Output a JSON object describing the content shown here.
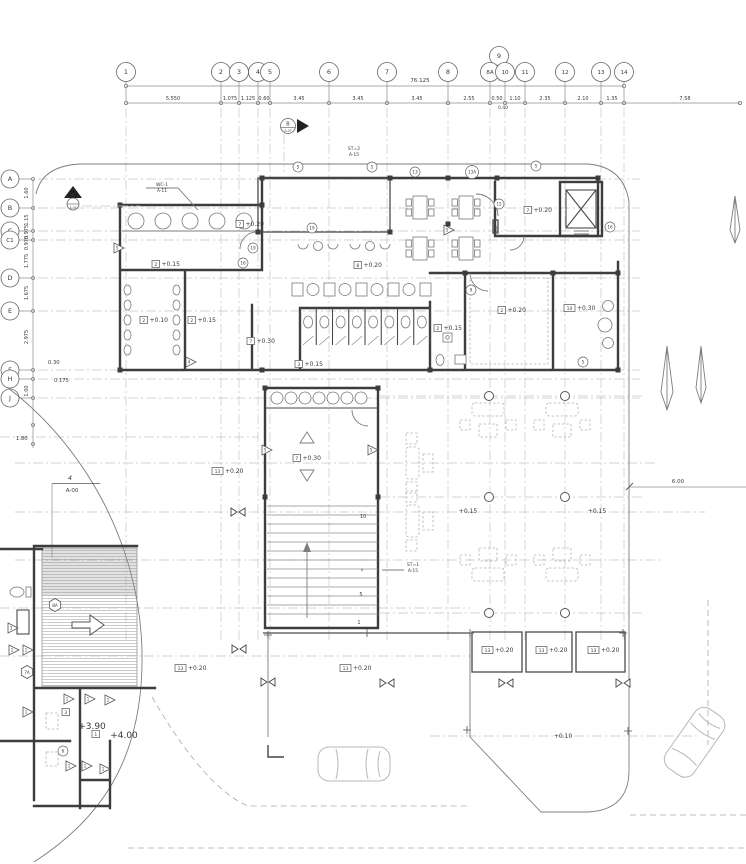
{
  "meta": {
    "bg": "#ffffff",
    "wall_color": "#3d3d3d",
    "grid_color": "#ccc2c2",
    "thin_color": "#8c8c8c",
    "text_color": "#3a3a3a"
  },
  "grid": {
    "cols": [
      {
        "l": "1",
        "x": 126
      },
      {
        "l": "2",
        "x": 221
      },
      {
        "l": "3",
        "x": 239
      },
      {
        "l": "4",
        "x": 258
      },
      {
        "l": "5",
        "x": 270
      },
      {
        "l": "6",
        "x": 329
      },
      {
        "l": "7",
        "x": 387
      },
      {
        "l": "8",
        "x": 448
      },
      {
        "l": "9",
        "x": 499,
        "y": 56,
        "nol": true
      },
      {
        "l": "8A",
        "x": 490
      },
      {
        "l": "10",
        "x": 505
      },
      {
        "l": "11",
        "x": 525
      },
      {
        "l": "12",
        "x": 565
      },
      {
        "l": "13",
        "x": 601
      },
      {
        "l": "14",
        "x": 624
      }
    ],
    "col_dims": [
      {
        "t": "5.550",
        "x": 173
      },
      {
        "t": "1.075",
        "x": 230
      },
      {
        "t": "1.125",
        "x": 248
      },
      {
        "t": "0.60",
        "x": 264
      },
      {
        "t": "3.45",
        "x": 299
      },
      {
        "t": "3.45",
        "x": 358
      },
      {
        "t": "3.45",
        "x": 417
      },
      {
        "t": "2.55",
        "x": 469
      },
      {
        "t": "0.50",
        "x": 497
      },
      {
        "t": "1.10",
        "x": 515
      },
      {
        "t": "2.35",
        "x": 545
      },
      {
        "t": "2.10",
        "x": 583
      },
      {
        "t": "1.35",
        "x": 612
      },
      {
        "t": "7.58",
        "x": 685
      }
    ],
    "overall": {
      "t": "76.125",
      "x": 420,
      "y": 82
    },
    "sub_dim": {
      "t": "0.40",
      "x": 503,
      "y": 109
    },
    "rows": [
      {
        "l": "A",
        "y": 179
      },
      {
        "l": "B",
        "y": 208
      },
      {
        "l": "C",
        "y": 231
      },
      {
        "l": "C1",
        "y": 240
      },
      {
        "l": "D",
        "y": 278
      },
      {
        "l": "E",
        "y": 311
      },
      {
        "l": "F",
        "y": 370
      },
      {
        "l": "H",
        "y": 379
      },
      {
        "l": "J",
        "y": 398
      }
    ],
    "row_dims": [
      {
        "t": "1.60",
        "y": 193
      },
      {
        "t": "1.15",
        "y": 220
      },
      {
        "t": "0.975",
        "y": 232
      },
      {
        "t": "0.975",
        "y": 243
      },
      {
        "t": "1.775",
        "y": 261
      },
      {
        "t": "1.675",
        "y": 293
      },
      {
        "t": "2.975",
        "y": 337
      },
      {
        "t": "1.00",
        "y": 391
      }
    ],
    "row_dims_h": [
      {
        "t": "0.30",
        "x": 48,
        "y": 364
      },
      {
        "t": "0.175",
        "x": 54,
        "y": 382
      },
      {
        "t": "1.80",
        "x": 16,
        "y": 440
      }
    ],
    "right_dim": {
      "t": "6.00",
      "x": 678,
      "y": 483
    },
    "rows2": [
      {
        "y": 396,
        "x1": 380,
        "x2": 645
      },
      {
        "y": 437,
        "x1": 0,
        "x2": 258
      },
      {
        "y": 463,
        "x1": 15,
        "x2": 655
      },
      {
        "y": 497,
        "x1": 380,
        "x2": 645
      },
      {
        "y": 512,
        "x1": 15,
        "x2": 705
      },
      {
        "y": 560,
        "x1": 15,
        "x2": 660
      },
      {
        "y": 608,
        "x1": 0,
        "x2": 470
      },
      {
        "y": 613,
        "x1": 380,
        "x2": 645
      },
      {
        "y": 656,
        "x1": 0,
        "x2": 470
      },
      {
        "y": 736,
        "x1": 430,
        "x2": 700
      }
    ]
  },
  "levels": [
    {
      "n": "2",
      "v": "+0.15",
      "x": 152,
      "y": 266
    },
    {
      "n": "2",
      "v": "+0.10",
      "x": 140,
      "y": 322
    },
    {
      "n": "2",
      "v": "+0.15",
      "x": 188,
      "y": 322
    },
    {
      "n": "7",
      "v": "+0.20",
      "x": 236,
      "y": 226
    },
    {
      "n": "8",
      "v": "+0.20",
      "x": 354,
      "y": 267
    },
    {
      "n": "7",
      "v": "+0.20",
      "x": 524,
      "y": 212
    },
    {
      "n": "2",
      "v": "+0.20",
      "x": 498,
      "y": 312
    },
    {
      "n": "10",
      "v": "+0.30",
      "x": 564,
      "y": 310
    },
    {
      "n": "2",
      "v": "+0.15",
      "x": 434,
      "y": 330
    },
    {
      "n": "7",
      "v": "+0.30",
      "x": 293,
      "y": 460
    },
    {
      "n": "7",
      "v": "+0.30",
      "x": 247,
      "y": 343
    },
    {
      "n": "3",
      "v": "+0.15",
      "x": 295,
      "y": 366
    },
    {
      "n": "13",
      "v": "+0.20",
      "x": 212,
      "y": 473
    },
    {
      "n": "13",
      "v": "+0.20",
      "x": 175,
      "y": 670
    },
    {
      "n": "13",
      "v": "+0.20",
      "x": 340,
      "y": 670
    },
    {
      "n": "13",
      "v": "+0.20",
      "x": 482,
      "y": 652
    },
    {
      "n": "13",
      "v": "+0.20",
      "x": 536,
      "y": 652
    },
    {
      "n": "13",
      "v": "+0.20",
      "x": 588,
      "y": 652
    },
    {
      "n": "3",
      "v": "",
      "x": 62,
      "y": 714
    },
    {
      "n": "1",
      "v": "",
      "x": 92,
      "y": 736
    }
  ],
  "labels": [
    {
      "t": "+0.15",
      "x": 468,
      "y": 513,
      "s": 6
    },
    {
      "t": "+0.15",
      "x": 597,
      "y": 513,
      "s": 6
    },
    {
      "t": "+0.10",
      "x": 563,
      "y": 738,
      "s": 6
    },
    {
      "t": "+3.90",
      "x": 92,
      "y": 729,
      "s": 9
    },
    {
      "t": "+4.00",
      "x": 124,
      "y": 738,
      "s": 9
    },
    {
      "t": "FHC",
      "x": 498,
      "y": 228,
      "s": 4,
      "r": -90
    },
    {
      "t": "10",
      "x": 363,
      "y": 518,
      "s": 5
    },
    {
      "t": "5",
      "x": 361,
      "y": 596,
      "s": 5
    },
    {
      "t": "1",
      "x": 359,
      "y": 624,
      "s": 5
    },
    {
      "t": "‹",
      "x": 362,
      "y": 572,
      "s": 7
    }
  ],
  "keynotes_circle": [
    {
      "t": "5",
      "x": 298,
      "y": 167
    },
    {
      "t": "5",
      "x": 372,
      "y": 167
    },
    {
      "t": "13",
      "x": 415,
      "y": 172
    },
    {
      "t": "13A",
      "x": 472,
      "y": 172
    },
    {
      "t": "5",
      "x": 536,
      "y": 166
    },
    {
      "t": "15",
      "x": 499,
      "y": 204
    },
    {
      "t": "16",
      "x": 610,
      "y": 227
    },
    {
      "t": "9",
      "x": 471,
      "y": 290
    },
    {
      "t": "19",
      "x": 312,
      "y": 228
    },
    {
      "t": "19",
      "x": 253,
      "y": 248
    },
    {
      "t": "16",
      "x": 243,
      "y": 263
    },
    {
      "t": "5",
      "x": 583,
      "y": 362
    },
    {
      "t": "6",
      "x": 63,
      "y": 751
    }
  ],
  "keynotes_hex": [
    {
      "t": "8A",
      "x": 55,
      "y": 605
    },
    {
      "t": "7A",
      "x": 27,
      "y": 672
    }
  ],
  "keynotes_tri": [
    {
      "t": "3",
      "x": 12,
      "y": 628
    },
    {
      "t": "1",
      "x": 13,
      "y": 650
    },
    {
      "t": "1",
      "x": 27,
      "y": 650
    },
    {
      "t": "1",
      "x": 68,
      "y": 699
    },
    {
      "t": "1",
      "x": 89,
      "y": 699
    },
    {
      "t": "1",
      "x": 109,
      "y": 700
    },
    {
      "t": "1",
      "x": 27,
      "y": 712
    },
    {
      "t": "1",
      "x": 70,
      "y": 766
    },
    {
      "t": "1",
      "x": 86,
      "y": 766
    },
    {
      "t": "1",
      "x": 104,
      "y": 769
    },
    {
      "t": "5",
      "x": 118,
      "y": 248
    },
    {
      "t": "4",
      "x": 190,
      "y": 362
    },
    {
      "t": "5",
      "x": 266,
      "y": 450
    },
    {
      "t": "5",
      "x": 372,
      "y": 450
    },
    {
      "t": "5",
      "x": 448,
      "y": 230
    }
  ],
  "markers": [
    {
      "type": "secA",
      "l": "A",
      "ref": "A-05",
      "x": 73,
      "y": 193
    },
    {
      "type": "secB",
      "l": "B",
      "ref": "A-07",
      "x": 288,
      "y": 126
    },
    {
      "type": "detail",
      "l": "4",
      "ref": "A-00",
      "x": 70,
      "y": 480
    },
    {
      "type": "callout",
      "l": "WC-1",
      "ref": "A-11",
      "x": 162,
      "y": 186,
      "leader": [
        [
          146,
          188
        ],
        [
          178,
          188
        ],
        [
          198,
          210
        ]
      ]
    },
    {
      "type": "callout",
      "l": "ST=2",
      "ref": "A-15",
      "x": 354,
      "y": 150
    },
    {
      "type": "callout",
      "l": "ST=1",
      "ref": "A-15",
      "x": 413,
      "y": 566,
      "leader": [
        [
          382,
          570
        ],
        [
          404,
          570
        ]
      ]
    }
  ]
}
